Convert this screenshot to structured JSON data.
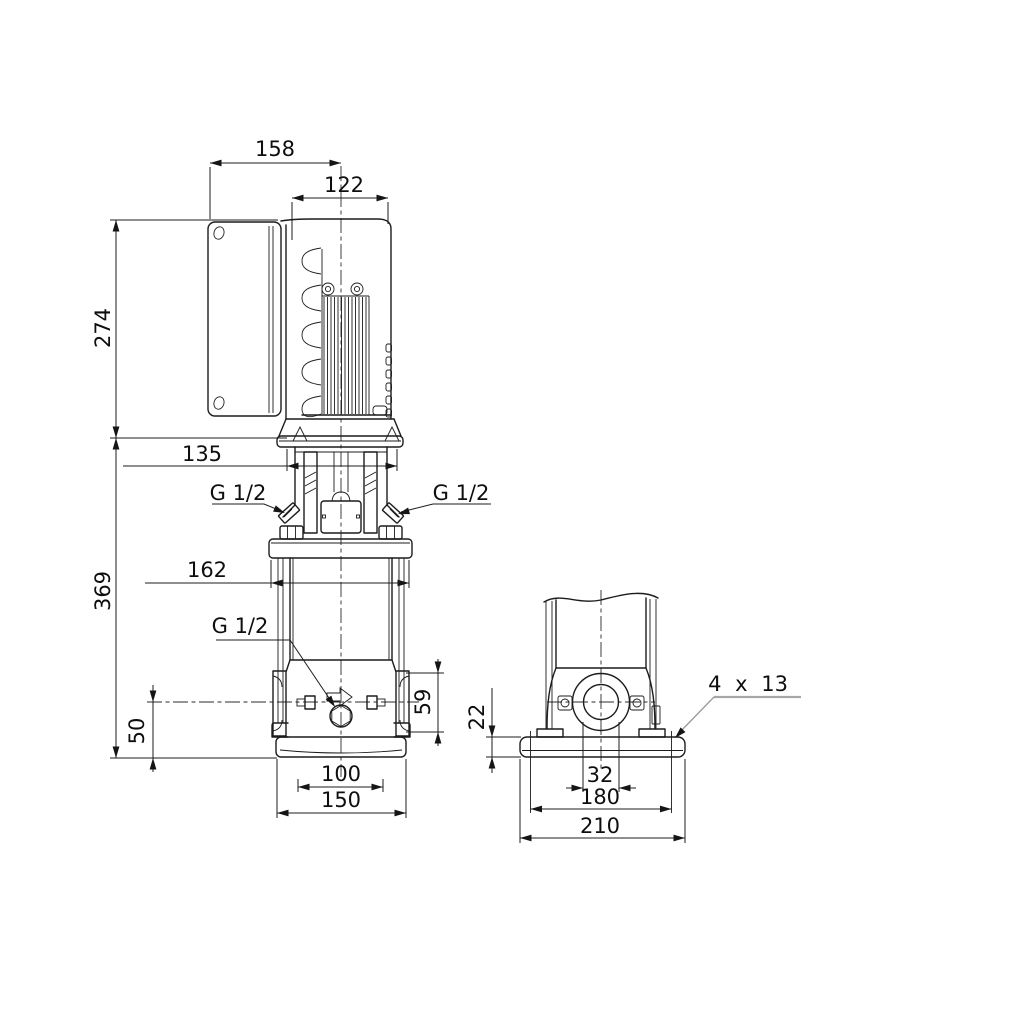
{
  "drawing": {
    "labels": {
      "top_width": "158",
      "motor_width": "122",
      "motor_height": "274",
      "coupling_width": "135",
      "pump_height": "369",
      "head_width": "162",
      "vent_left": "G 1/2",
      "vent_right": "G 1/2",
      "drain": "G 1/2",
      "port_center_height": "50",
      "port_flange_height": "59",
      "base_front_hole_span": "100",
      "base_front_width": "150",
      "base_plate_height": "22",
      "port_bore": "32",
      "base_side_hole_span": "180",
      "base_side_width": "210",
      "mounting_holes": "4 x 13"
    }
  }
}
